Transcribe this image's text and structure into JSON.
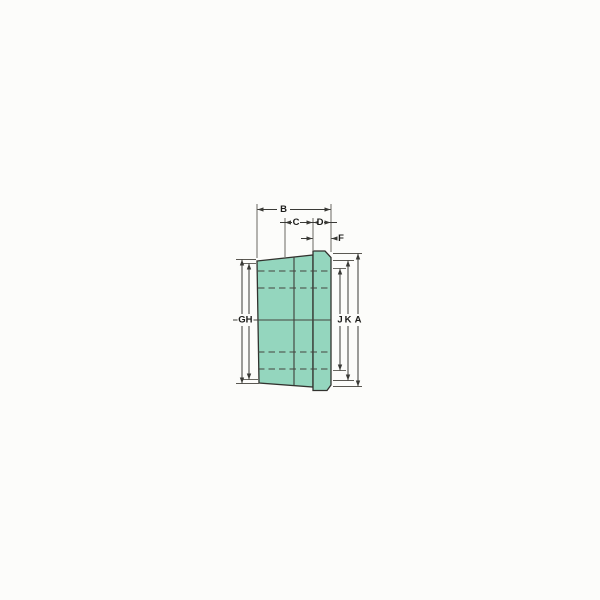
{
  "diagram": {
    "background": "#fcfcfa",
    "part_fill": "#94d6be",
    "line_color": "#3a3a36",
    "labels": {
      "A": "A",
      "B": "B",
      "C": "C",
      "D": "D",
      "F": "F",
      "G": "G",
      "H": "H",
      "J": "J",
      "K": "K"
    }
  }
}
